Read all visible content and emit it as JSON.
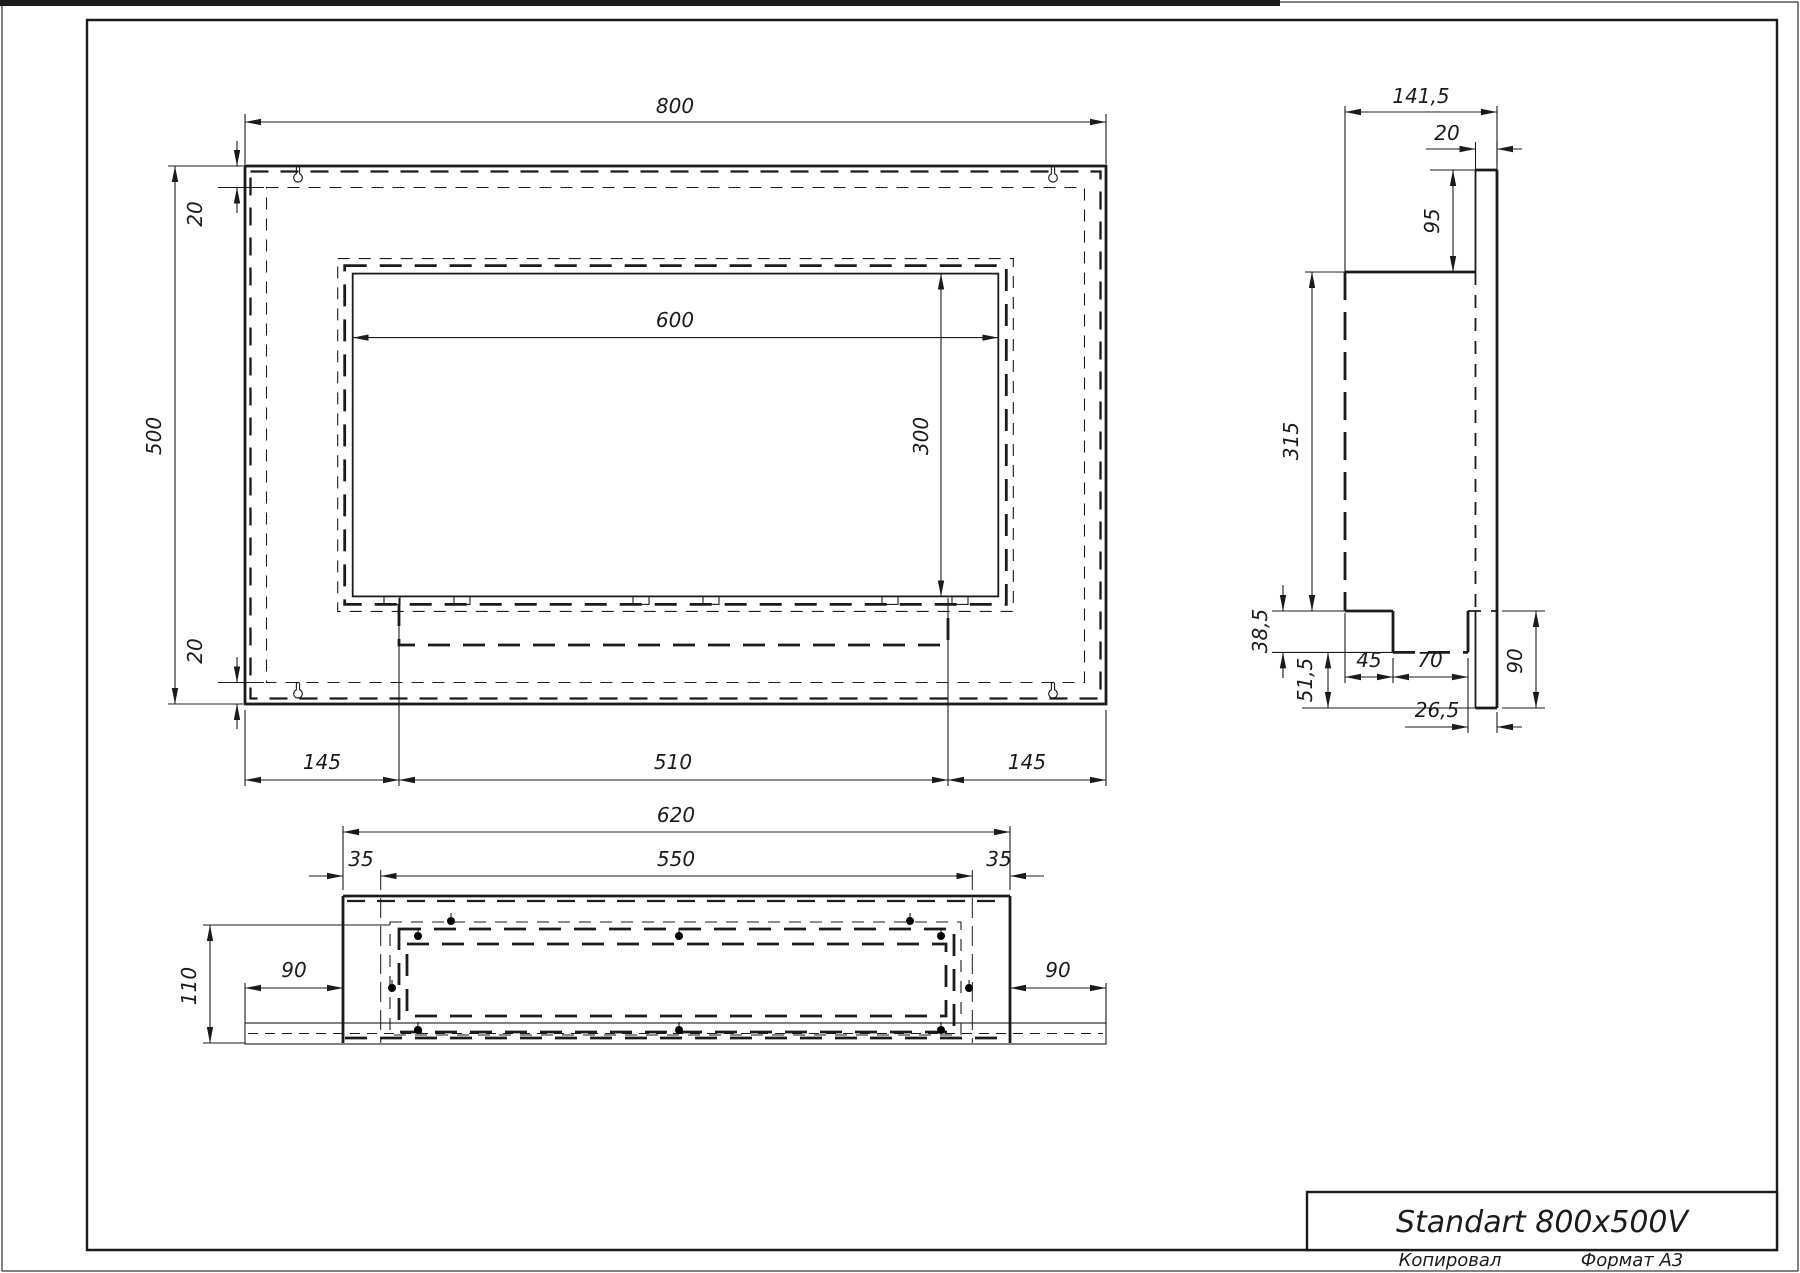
{
  "colors": {
    "line": "#1b1b1b",
    "background": "#ffffff"
  },
  "title_block": {
    "title": "Standart 800x500V",
    "footer_left": "Копировал",
    "footer_right": "Формат А3"
  },
  "front_view": {
    "dims": {
      "overall_width": "800",
      "overall_height": "500",
      "top_inset": "20",
      "bottom_inset": "20",
      "opening_width": "600",
      "opening_height": "300",
      "left_margin": "145",
      "tray_width": "510",
      "right_margin": "145"
    }
  },
  "side_view": {
    "dims": {
      "overall_depth": "141,5",
      "backplate_thickness": "20",
      "backplate_top_extension": "95",
      "body_height": "315",
      "burner_depth": "38,5",
      "burner_bottom_offset": "51,5",
      "burner_setback": "45",
      "burner_width": "70",
      "burner_to_back": "26,5",
      "backplate_bottom_extension": "90"
    }
  },
  "bottom_view": {
    "dims": {
      "body_width": "620",
      "inner_width": "550",
      "left_inset": "35",
      "right_inset": "35",
      "body_depth": "110",
      "left_plate_extension": "90",
      "right_plate_extension": "90"
    }
  }
}
